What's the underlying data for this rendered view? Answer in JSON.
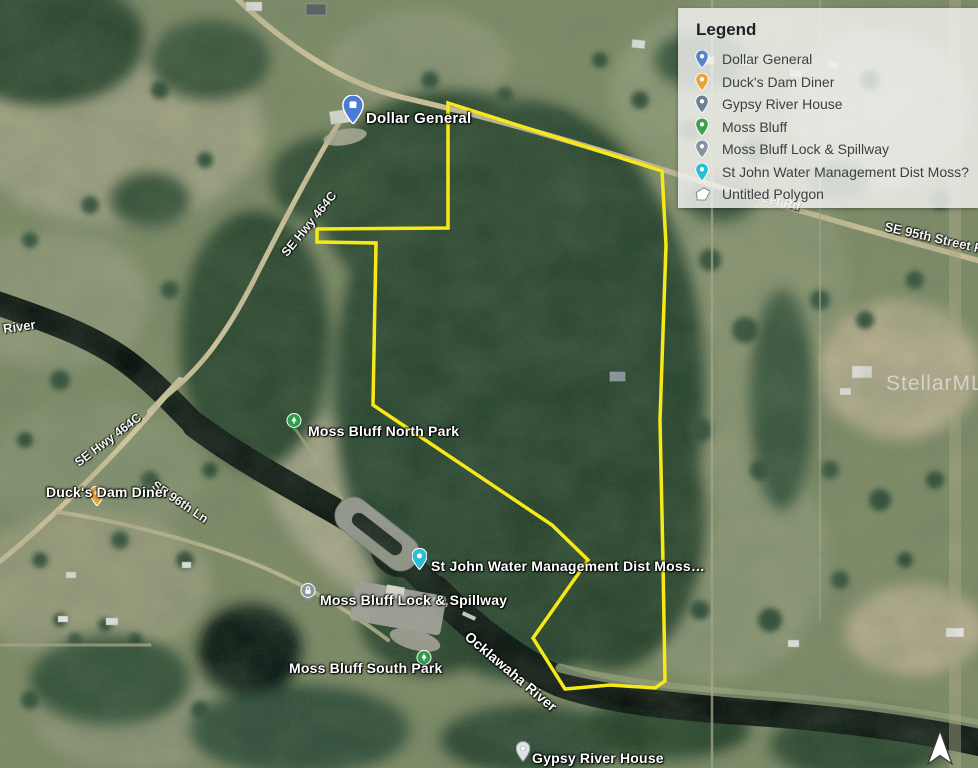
{
  "map": {
    "boundary_color": "#f7e918",
    "watermark": "StellarMLS",
    "labels": [
      {
        "id": "dollar-general",
        "text": "Dollar General"
      },
      {
        "id": "hwy-464c-upper",
        "text": "SE Hwy 464C"
      },
      {
        "id": "hwy-464c-lower",
        "text": "SE Hwy 464C"
      },
      {
        "id": "river",
        "text": "River"
      },
      {
        "id": "street-rd",
        "text": "Street Rd"
      },
      {
        "id": "se-95th-street-rd",
        "text": "SE 95th Street Rd"
      },
      {
        "id": "moss-bluff-north-park",
        "text": "Moss Bluff North Park"
      },
      {
        "id": "ducks-dam-diner",
        "text": "Duck's Dam Diner"
      },
      {
        "id": "se-96th-ln",
        "text": "SE 96th Ln"
      },
      {
        "id": "st-john-water",
        "text": "St John Water Management Dist Moss…"
      },
      {
        "id": "moss-bluff-lock",
        "text": "Moss Bluff Lock & Spillway"
      },
      {
        "id": "moss-bluff-south-park",
        "text": "Moss Bluff South Park"
      },
      {
        "id": "ocklawaha-river",
        "text": "Ocklawaha River"
      },
      {
        "id": "gypsy-river-house",
        "text": "Gypsy River House"
      }
    ],
    "pins": [
      {
        "id": "dollar-general",
        "color": "#4b7bd4"
      },
      {
        "id": "ducks-dam-diner",
        "color": "#e8a33d"
      },
      {
        "id": "st-john-water",
        "color": "#2bbdd6"
      },
      {
        "id": "gypsy-river-house",
        "color": "#dfe3e6"
      },
      {
        "id": "moss-bluff-north-park",
        "color": "#2f9e4c"
      },
      {
        "id": "moss-bluff-south-park",
        "color": "#2f9e4c"
      },
      {
        "id": "moss-bluff-lock",
        "color": "#8c97a1"
      }
    ]
  },
  "legend": {
    "title": "Legend",
    "items": [
      {
        "label": "Dollar General",
        "icon": "pin",
        "color": "#5a82c9"
      },
      {
        "label": "Duck's Dam Diner",
        "icon": "pin",
        "color": "#e8a33d"
      },
      {
        "label": "Gypsy River House",
        "icon": "pin",
        "color": "#6d7f92"
      },
      {
        "label": "Moss Bluff",
        "icon": "pin",
        "color": "#3f9e4d"
      },
      {
        "label": "Moss Bluff Lock & Spillway",
        "icon": "pin",
        "color": "#8794a0"
      },
      {
        "label": "St John Water Management Dist Moss?",
        "icon": "pin",
        "color": "#27bdd7"
      },
      {
        "label": "Untitled Polygon",
        "icon": "polygon",
        "color": "#ffffff"
      }
    ]
  }
}
